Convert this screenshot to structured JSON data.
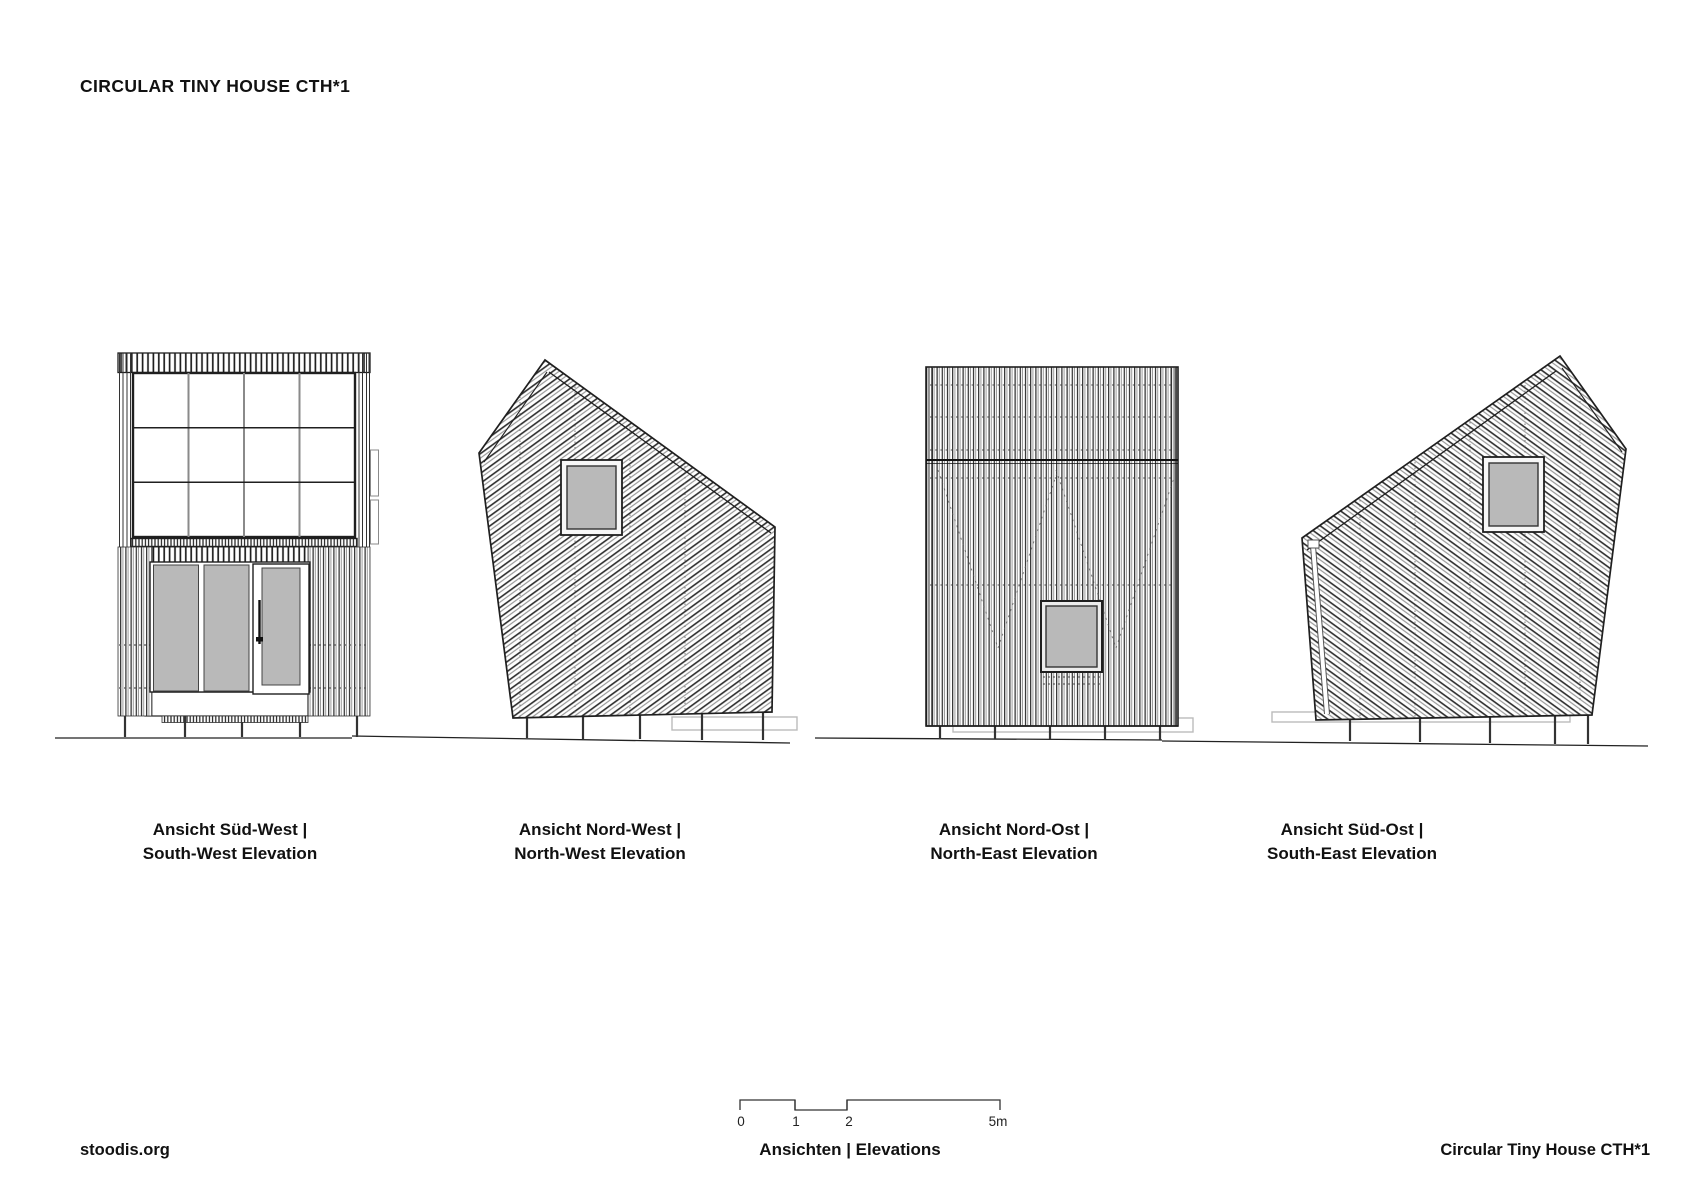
{
  "title": "CIRCULAR TINY HOUSE CTH*1",
  "elevations": [
    {
      "label_de": "Ansicht Süd-West |",
      "label_en": "South-West Elevation"
    },
    {
      "label_de": "Ansicht Nord-West |",
      "label_en": "North-West Elevation"
    },
    {
      "label_de": "Ansicht Nord-Ost |",
      "label_en": "North-East Elevation"
    },
    {
      "label_de": "Ansicht Süd-Ost |",
      "label_en": "South-East Elevation"
    }
  ],
  "scale_bar": {
    "tick_labels": [
      "0",
      "1",
      "2",
      "5m"
    ]
  },
  "footer": {
    "left": "stoodis.org",
    "center": "Ansichten | Elevations",
    "right": "Circular Tiny House CTH*1"
  },
  "colors": {
    "line": "#222222",
    "glass": "#b9b9b9",
    "hatch_dark": "#2a2a2a",
    "hatch_light": "#9a9a9a",
    "platform": "#bbbbbb"
  }
}
